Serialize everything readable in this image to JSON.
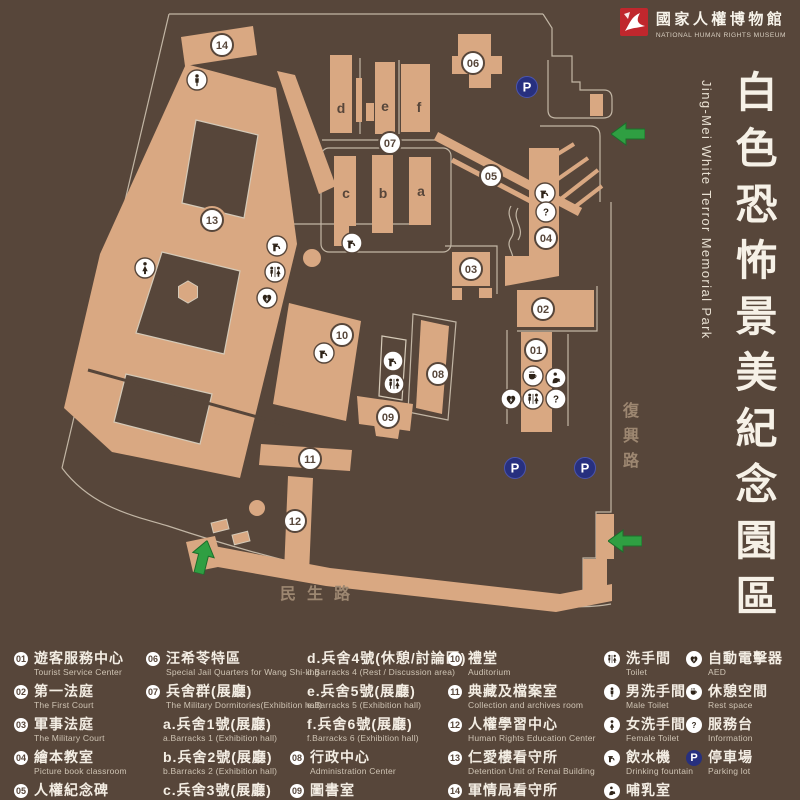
{
  "logo": {
    "zh": "國家人權博物館",
    "en": "NATIONAL HUMAN RIGHTS MUSEUM"
  },
  "title": {
    "zh": "白色恐怖景美紀念園區",
    "en": "Jing-Mei White Terror Memorial Park"
  },
  "colors": {
    "background": "#57463a",
    "building": "#d9a882",
    "outline": "#d5cab8",
    "logo_red": "#c0272d",
    "parking_blue": "#27307f",
    "arrow_green": "#2f9f42",
    "road_text": "#9d8771"
  },
  "map": {
    "roads": {
      "minsheng": "民生路",
      "fuxing": "復興路"
    },
    "letters": [
      {
        "ch": "d",
        "x": 341,
        "y": 113
      },
      {
        "ch": "e",
        "x": 385,
        "y": 111
      },
      {
        "ch": "f",
        "x": 419,
        "y": 112
      },
      {
        "ch": "c",
        "x": 346,
        "y": 198
      },
      {
        "ch": "b",
        "x": 383,
        "y": 198
      },
      {
        "ch": "a",
        "x": 421,
        "y": 196
      }
    ],
    "markers": [
      {
        "t": "num",
        "n": "14",
        "x": 222,
        "y": 45
      },
      {
        "t": "num",
        "n": "06",
        "x": 473,
        "y": 63
      },
      {
        "t": "num",
        "n": "07",
        "x": 390,
        "y": 143
      },
      {
        "t": "num",
        "n": "05",
        "x": 491,
        "y": 176
      },
      {
        "t": "num",
        "n": "13",
        "x": 212,
        "y": 220
      },
      {
        "t": "num",
        "n": "04",
        "x": 546,
        "y": 238
      },
      {
        "t": "num",
        "n": "03",
        "x": 471,
        "y": 269
      },
      {
        "t": "num",
        "n": "02",
        "x": 543,
        "y": 309
      },
      {
        "t": "num",
        "n": "10",
        "x": 342,
        "y": 335
      },
      {
        "t": "num",
        "n": "01",
        "x": 536,
        "y": 350
      },
      {
        "t": "num",
        "n": "08",
        "x": 438,
        "y": 374
      },
      {
        "t": "num",
        "n": "09",
        "x": 388,
        "y": 417
      },
      {
        "t": "num",
        "n": "11",
        "x": 310,
        "y": 459
      },
      {
        "t": "num",
        "n": "12",
        "x": 295,
        "y": 521
      },
      {
        "t": "icon",
        "icon": "male",
        "x": 197,
        "y": 80
      },
      {
        "t": "icon",
        "icon": "female",
        "x": 145,
        "y": 268
      },
      {
        "t": "icon",
        "icon": "fountain",
        "x": 277,
        "y": 246
      },
      {
        "t": "icon",
        "icon": "toilet",
        "x": 275,
        "y": 272
      },
      {
        "t": "icon",
        "icon": "aed",
        "x": 267,
        "y": 298
      },
      {
        "t": "icon",
        "icon": "fountain",
        "x": 352,
        "y": 243
      },
      {
        "t": "icon",
        "icon": "fountain",
        "x": 324,
        "y": 353
      },
      {
        "t": "icon",
        "icon": "fountain",
        "x": 393,
        "y": 361
      },
      {
        "t": "icon",
        "icon": "toilet",
        "x": 394,
        "y": 384
      },
      {
        "t": "icon",
        "icon": "fountain",
        "x": 545,
        "y": 193
      },
      {
        "t": "icon",
        "icon": "info",
        "x": 546,
        "y": 212
      },
      {
        "t": "icon",
        "icon": "rest",
        "x": 533,
        "y": 376
      },
      {
        "t": "icon",
        "icon": "nursing",
        "x": 556,
        "y": 378
      },
      {
        "t": "icon",
        "icon": "aed",
        "x": 511,
        "y": 399
      },
      {
        "t": "icon",
        "icon": "toilet",
        "x": 533,
        "y": 399
      },
      {
        "t": "icon",
        "icon": "info",
        "x": 556,
        "y": 399
      },
      {
        "t": "p",
        "n": "P",
        "x": 527,
        "y": 87
      },
      {
        "t": "p",
        "n": "P",
        "x": 515,
        "y": 468
      },
      {
        "t": "p",
        "n": "P",
        "x": 585,
        "y": 468
      }
    ]
  },
  "legend": {
    "columns": [
      {
        "x": 14,
        "items": [
          {
            "badge": "01",
            "zh": "遊客服務中心",
            "en": "Tourist Service Center"
          },
          {
            "badge": "02",
            "zh": "第一法庭",
            "en": "The First Court"
          },
          {
            "badge": "03",
            "zh": "軍事法庭",
            "en": "The Military Court"
          },
          {
            "badge": "04",
            "zh": "繪本教室",
            "en": "Picture book classroom"
          },
          {
            "badge": "05",
            "zh": "人權紀念碑",
            "en": "Human Rights Memorial"
          }
        ]
      },
      {
        "x": 146,
        "items": [
          {
            "badge": "06",
            "zh": "汪希苓特區",
            "en": "Special Jail Quarters for Wang Shi-ling"
          },
          {
            "badge": "07",
            "zh": "兵舍群(展廳)",
            "en": "The Military Dormitories(Exhibition hall)"
          },
          {
            "indent": true,
            "zh": "a.兵舍1號(展廳)",
            "en": "a.Barracks 1 (Exhibition hall)"
          },
          {
            "indent": true,
            "zh": "b.兵舍2號(展廳)",
            "en": "b.Barracks 2 (Exhibition hall)"
          },
          {
            "indent": true,
            "zh": "c.兵舍3號(展廳)",
            "en": "c.Barracks 3 (Exhibition hall)"
          }
        ]
      },
      {
        "x": 290,
        "items": [
          {
            "indent": true,
            "zh": "d.兵舍4號(休憩/討論區)",
            "en": "d.Barracks 4 (Rest / Discussion area)"
          },
          {
            "indent": true,
            "zh": "e.兵舍5號(展廳)",
            "en": "e.Barracks 5 (Exhibition hall)"
          },
          {
            "indent": true,
            "zh": "f.兵舍6號(展廳)",
            "en": "f.Barracks 6 (Exhibition hall)"
          },
          {
            "badge": "08",
            "zh": "行政中心",
            "en": "Administration Center"
          },
          {
            "badge": "09",
            "zh": "圖書室",
            "en": "Library"
          }
        ]
      },
      {
        "x": 448,
        "items": [
          {
            "badge": "10",
            "zh": "禮堂",
            "en": "Auditorium"
          },
          {
            "badge": "11",
            "zh": "典藏及檔案室",
            "en": "Collection and archives room"
          },
          {
            "badge": "12",
            "zh": "人權學習中心",
            "en": "Human Rights Education Center"
          },
          {
            "badge": "13",
            "zh": "仁愛樓看守所",
            "en": "Detention Unit of Renai Building"
          },
          {
            "badge": "14",
            "zh": "軍情局看守所",
            "en": "Detention Unit of Military Intelligence Bureau"
          }
        ]
      },
      {
        "x": 604,
        "items": [
          {
            "icon": "toilet",
            "zh": "洗手間",
            "en": "Toilet"
          },
          {
            "icon": "male",
            "zh": "男洗手間",
            "en": "Male Toilet"
          },
          {
            "icon": "female",
            "zh": "女洗手間",
            "en": "Female Toilet"
          },
          {
            "icon": "fountain",
            "zh": "飲水機",
            "en": "Drinking fountain"
          },
          {
            "icon": "nursing",
            "zh": "哺乳室",
            "en": "Nursing room"
          }
        ]
      },
      {
        "x": 686,
        "items": [
          {
            "icon": "aed",
            "zh": "自動電擊器",
            "en": "AED"
          },
          {
            "icon": "rest",
            "zh": "休憩空間",
            "en": "Rest space"
          },
          {
            "icon": "info",
            "zh": "服務台",
            "en": "Information"
          },
          {
            "icon": "parking",
            "zh": "停車場",
            "en": "Parking lot"
          }
        ]
      }
    ]
  }
}
